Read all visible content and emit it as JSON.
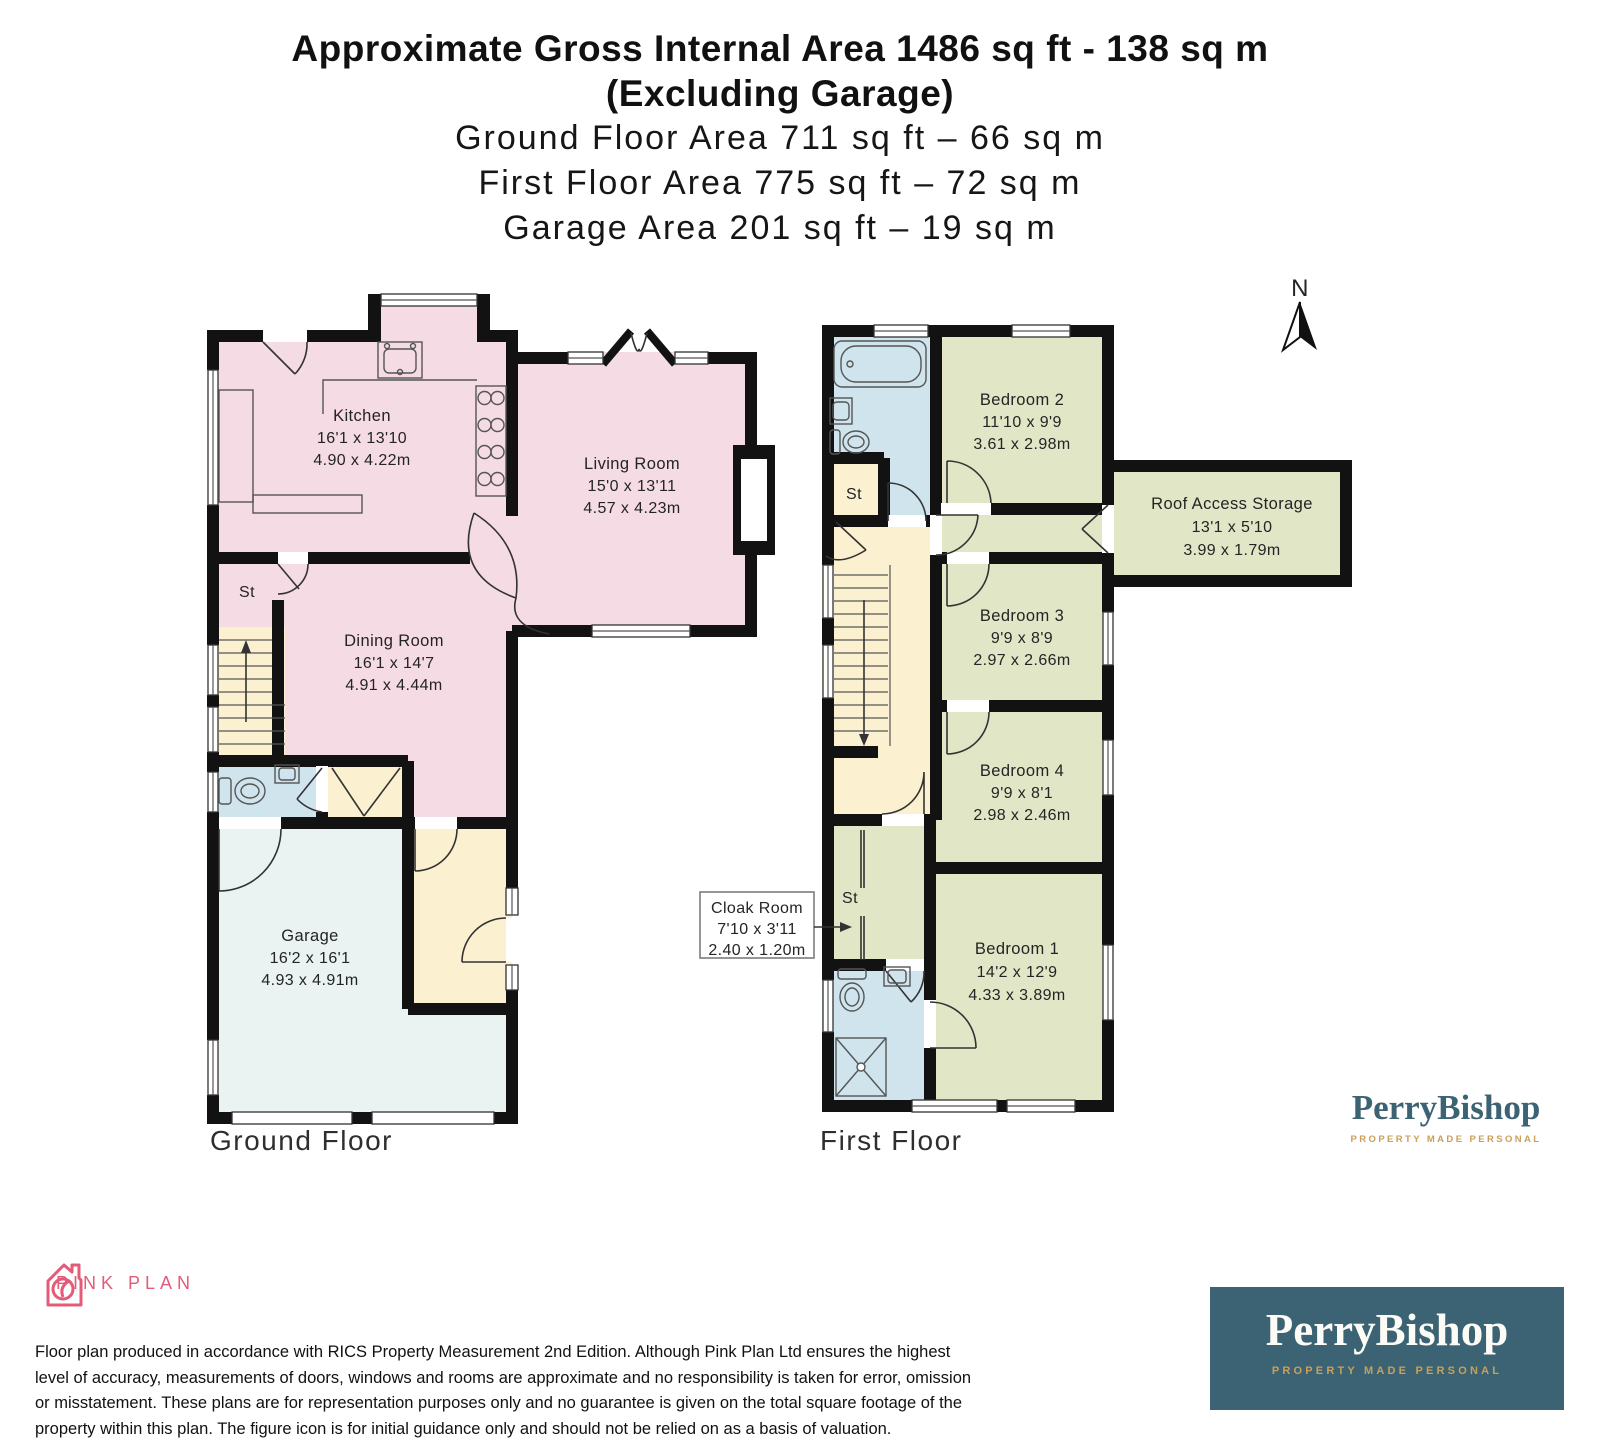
{
  "title": {
    "line1": "Approximate Gross Internal Area 1486 sq ft - 138 sq m",
    "line2": "(Excluding Garage)",
    "line3": "Ground Floor Area 711 sq ft – 66 sq m",
    "line4": "First Floor Area 775 sq ft – 72 sq m",
    "line5": "Garage Area 201 sq ft – 19 sq m"
  },
  "ground_floor": {
    "label": "Ground Floor",
    "rooms": {
      "kitchen": {
        "name": "Kitchen",
        "dims_ft": "16'1 x 13'10",
        "dims_m": "4.90 x 4.22m"
      },
      "living_room": {
        "name": "Living Room",
        "dims_ft": "15'0 x 13'11",
        "dims_m": "4.57 x 4.23m"
      },
      "dining_room": {
        "name": "Dining Room",
        "dims_ft": "16'1 x 14'7",
        "dims_m": "4.91 x 4.44m"
      },
      "garage": {
        "name": "Garage",
        "dims_ft": "16'2 x 16'1",
        "dims_m": "4.93 x 4.91m"
      },
      "storage": {
        "name": "St"
      }
    }
  },
  "first_floor": {
    "label": "First Floor",
    "rooms": {
      "bedroom2": {
        "name": "Bedroom 2",
        "dims_ft": "11'10 x 9'9",
        "dims_m": "3.61 x 2.98m"
      },
      "roof_access_storage": {
        "name": "Roof Access Storage",
        "dims_ft": "13'1 x 5'10",
        "dims_m": "3.99 x 1.79m"
      },
      "bedroom3": {
        "name": "Bedroom 3",
        "dims_ft": "9'9 x 8'9",
        "dims_m": "2.97 x 2.66m"
      },
      "bedroom4": {
        "name": "Bedroom 4",
        "dims_ft": "9'9 x 8'1",
        "dims_m": "2.98 x 2.46m"
      },
      "bedroom1": {
        "name": "Bedroom 1",
        "dims_ft": "14'2 x 12'9",
        "dims_m": "4.33 x 3.89m"
      },
      "cloak_room": {
        "name": "Cloak Room",
        "dims_ft": "7'10 x 3'11",
        "dims_m": "2.40 x 1.20m"
      },
      "storage_upper": {
        "name": "St"
      },
      "storage_lower": {
        "name": "St"
      }
    }
  },
  "compass": {
    "north_label": "N"
  },
  "branding": {
    "perrybishop": {
      "name": "PerryBishop",
      "tagline": "PROPERTY MADE PERSONAL"
    },
    "pinkplan": {
      "name": "PINK PLAN"
    }
  },
  "disclaimer": {
    "line1": "Floor plan produced in accordance with RICS Property Measurement 2nd Edition. Although Pink Plan Ltd ensures the highest",
    "line2": "level of accuracy, measurements of doors, windows and rooms are approximate and no responsibility is taken for error, omission",
    "line3": "or misstatement. These plans are for representation purposes only and no guarantee is given on the total square footage of the",
    "line4": "property within this plan. The figure icon is for initial guidance only and should not be relied on as a basis of valuation."
  },
  "colors": {
    "room_pink": "#f5dbe3",
    "room_cream": "#fbf0cf",
    "room_blue": "#cfe4ed",
    "room_garage": "#eaf2f2",
    "room_green": "#e1e6c6",
    "wall": "#121212",
    "fixture_line": "#555555",
    "brand_teal": "#3c6374",
    "brand_gold": "#c9a05a",
    "brand_pink": "#e25c79",
    "callout_border": "#8a8a8a"
  }
}
